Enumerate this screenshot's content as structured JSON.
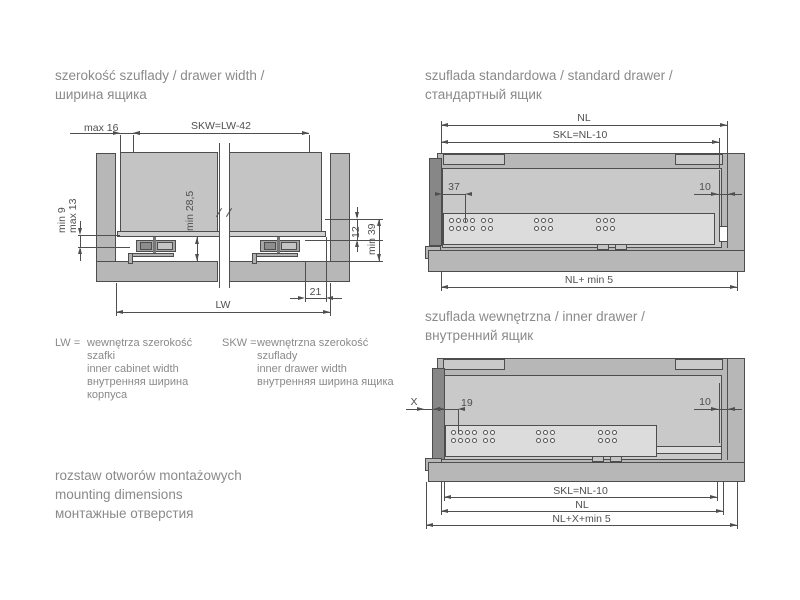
{
  "colors": {
    "panel": "#b7b7b7",
    "panel_light": "#c9c9c9",
    "rail": "#dcdcdc",
    "dark_bar": "#878787",
    "line": "#4f4f4f",
    "text": "#8a8a8a"
  },
  "left": {
    "title": [
      "szerokość szuflady / drawer width /",
      "ширина ящика"
    ],
    "dims": {
      "max16": "max 16",
      "skw": "SKW=LW-42",
      "min9": "min 9",
      "max13": "max 13",
      "min285": "min 28,5",
      "d12": "12",
      "min39": "min 39",
      "d21": "21",
      "lw": "LW"
    },
    "legend_lw": {
      "term": "LW =",
      "lines": [
        "wewnętrza szerokość",
        "szafki",
        "inner cabinet width",
        "внутренняя ширина",
        "корпуса"
      ]
    },
    "legend_skw": {
      "term": "SKW =",
      "lines": [
        "wewnętrzna szerokość",
        "szuflady",
        "inner drawer width",
        "внутренняя ширина ящика"
      ]
    },
    "mounting": [
      "rozstaw otworów montażowych",
      "mounting dimensions",
      "монтажные отверстия"
    ]
  },
  "standard": {
    "title": [
      "szuflada standardowa / standard drawer /",
      "стандартный ящик"
    ],
    "dims": {
      "nl": "NL",
      "skl": "SKL=NL-10",
      "d37": "37",
      "d10": "10",
      "nl_min5": "NL+ min 5"
    }
  },
  "inner": {
    "title": [
      "szuflada wewnętrzna / inner drawer /",
      "внутренний ящик"
    ],
    "dims": {
      "x": "X",
      "d19": "19",
      "d10": "10",
      "skl": "SKL=NL-10",
      "nl": "NL",
      "nl_x_min5": "NL+X+min 5"
    }
  }
}
